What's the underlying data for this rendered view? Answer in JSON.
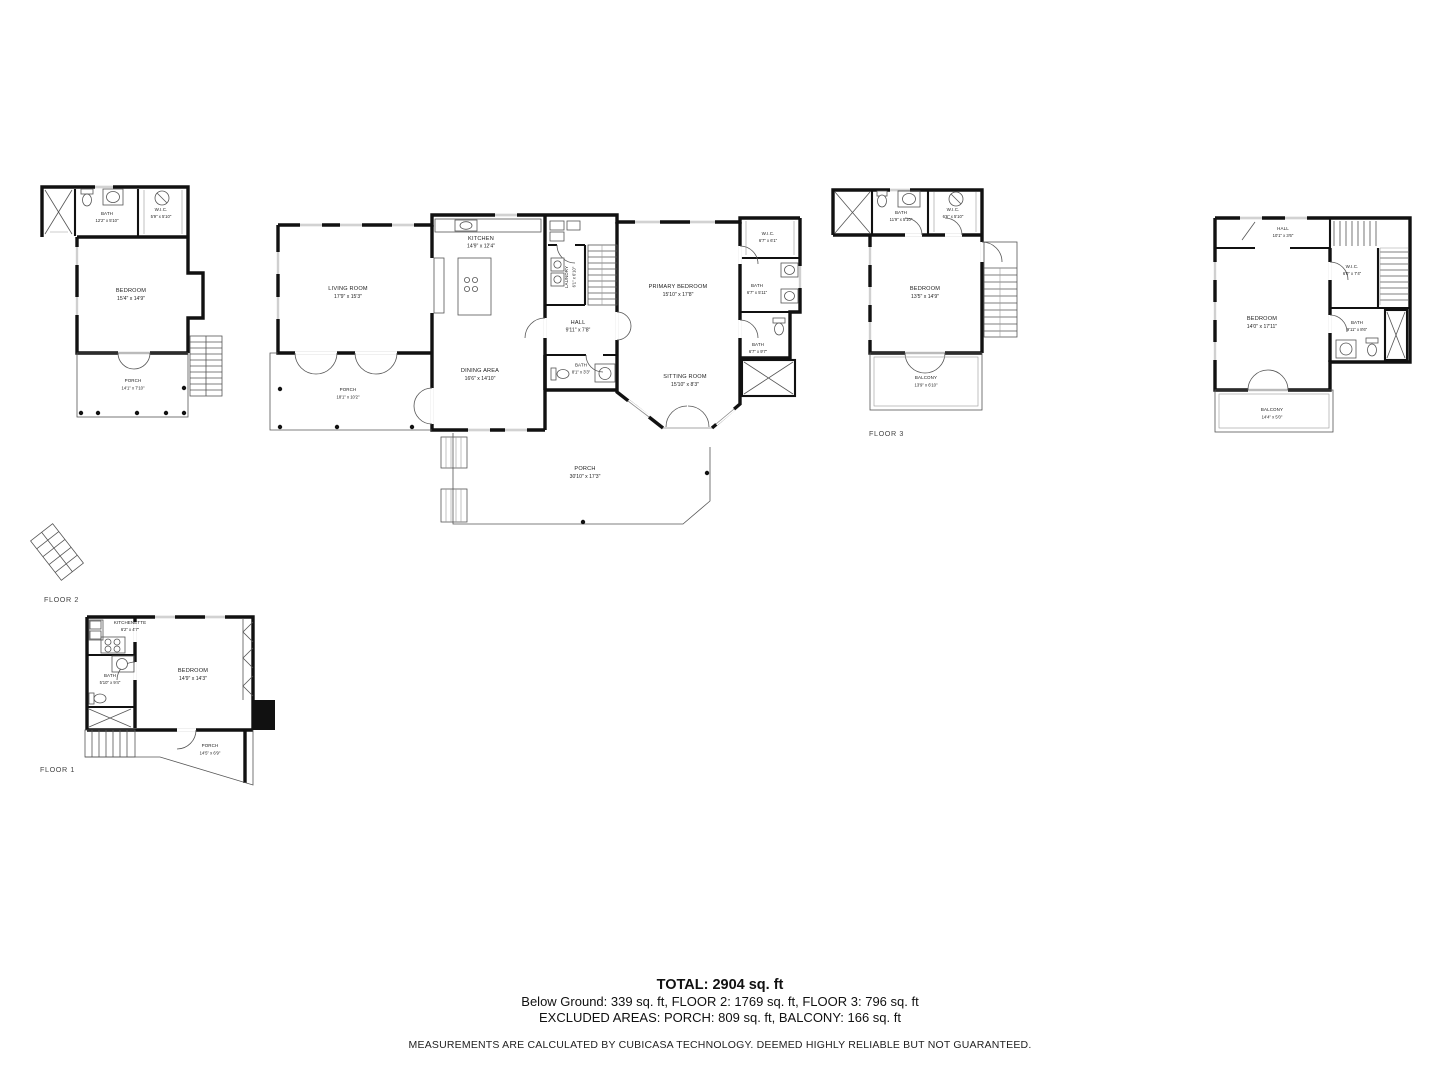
{
  "floor_labels": {
    "floor1": "FLOOR 1",
    "floor2": "FLOOR 2",
    "floor3": "FLOOR 3"
  },
  "floor2": {
    "left": {
      "bath": {
        "name": "BATH",
        "dims": "12'2\" x 5'10\""
      },
      "wic": {
        "name": "W.I.C.",
        "dims": "5'9\" x 5'10\""
      },
      "bedroom": {
        "name": "BEDROOM",
        "dims": "15'4\" x 14'9\""
      },
      "porch": {
        "name": "PORCH",
        "dims": "14'1\" x 7'10\""
      }
    },
    "main": {
      "living_room": {
        "name": "LIVING ROOM",
        "dims": "17'9\" x 15'3\""
      },
      "kitchen": {
        "name": "KITCHEN",
        "dims": "14'9\" x 12'4\""
      },
      "dining_area": {
        "name": "DINING AREA",
        "dims": "16'6\" x 14'10\""
      },
      "laundry": {
        "name": "LAUNDRY",
        "dims": "6'1\" x 6'10\""
      },
      "hall": {
        "name": "HALL",
        "dims": "9'11\" x 7'8\""
      },
      "primary_bedroom": {
        "name": "PRIMARY BEDROOM",
        "dims": "15'10\" x 17'8\""
      },
      "wic": {
        "name": "W.I.C.",
        "dims": "6'7\" x 6'1\""
      },
      "bath_upper": {
        "name": "BATH",
        "dims": "6'7\" x 5'11\""
      },
      "bath_lower": {
        "name": "BATH",
        "dims": "6'7\" x 9'7\""
      },
      "bath_hall": {
        "name": "BATH",
        "dims": "8'1\" x 3'3\""
      },
      "sitting_room": {
        "name": "SITTING ROOM",
        "dims": "15'10\" x 8'3\""
      },
      "porch_west": {
        "name": "PORCH",
        "dims": "18'1\" x 10'2\""
      },
      "porch_south": {
        "name": "PORCH",
        "dims": "30'10\" x 17'3\""
      }
    }
  },
  "floor3": {
    "unit_a": {
      "bath": {
        "name": "BATH",
        "dims": "11'9\" x 5'10\""
      },
      "wic": {
        "name": "W.I.C.",
        "dims": "6'6\" x 5'10\""
      },
      "bedroom": {
        "name": "BEDROOM",
        "dims": "13'5\" x 14'9\""
      },
      "balcony": {
        "name": "BALCONY",
        "dims": "13'9\" x 6'10\""
      }
    },
    "unit_b": {
      "hall": {
        "name": "HALL",
        "dims": "10'1\" x 3'6\""
      },
      "wic": {
        "name": "W.I.C.",
        "dims": "6'0\" x 7'4\""
      },
      "bedroom": {
        "name": "BEDROOM",
        "dims": "14'0\" x 17'11\""
      },
      "bath": {
        "name": "BATH",
        "dims": "9'11\" x 8'6\""
      },
      "balcony": {
        "name": "BALCONY",
        "dims": "14'4\" x 5'0\""
      }
    }
  },
  "floor1": {
    "kitchenette": {
      "name": "KITCHENETTE",
      "dims": "6'2\" x 4'7\""
    },
    "bath": {
      "name": "BATH",
      "dims": "5'10\" x 9'4\""
    },
    "bedroom": {
      "name": "BEDROOM",
      "dims": "14'9\" x 14'3\""
    },
    "porch": {
      "name": "PORCH",
      "dims": "14'5\" x 6'9\""
    }
  },
  "summary": {
    "total": "TOTAL: 2904 sq. ft",
    "floors_line": "Below Ground: 339 sq. ft, FLOOR 2: 1769 sq. ft, FLOOR 3: 796 sq. ft",
    "excluded_line": "EXCLUDED AREAS: PORCH: 809 sq. ft, BALCONY: 166 sq. ft",
    "disclaimer": "MEASUREMENTS ARE CALCULATED BY CUBICASA TECHNOLOGY. DEEMED HIGHLY RELIABLE BUT NOT GUARANTEED."
  },
  "colors": {
    "wall": "#111111",
    "thin_line": "#555555",
    "background": "#ffffff"
  }
}
